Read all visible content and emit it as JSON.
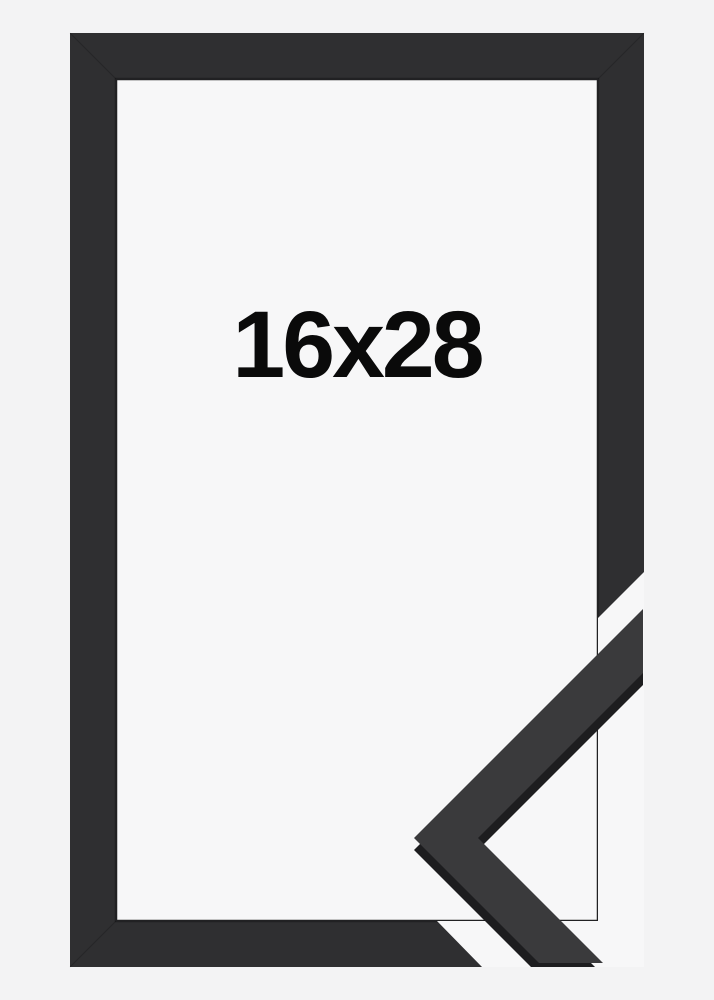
{
  "label": {
    "size_text": "16x28"
  },
  "colors": {
    "background": "#f3f3f4",
    "inner_backing": "#f7f7f8",
    "frame_face": "#2f2f31",
    "frame_inner_edge": "#212123",
    "profile_top_surface": "#3a3a3c",
    "profile_side_face": "#1d1d1f",
    "label_text": "#0a0a0a",
    "miter_seam": "#000000"
  }
}
